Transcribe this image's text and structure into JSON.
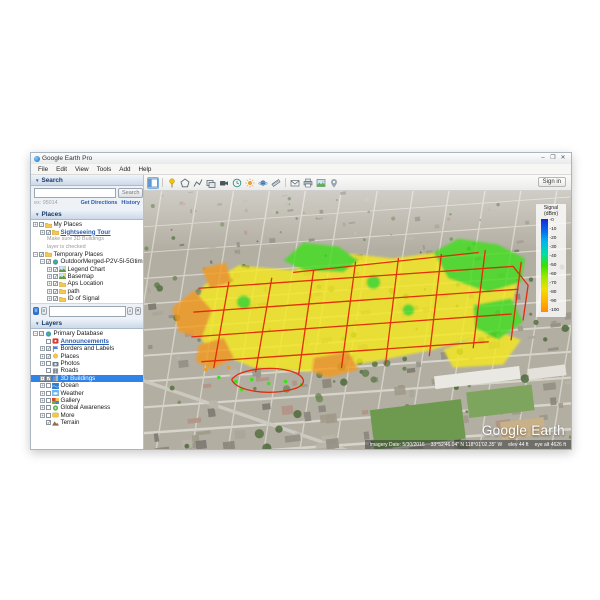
{
  "window": {
    "title": "Google Earth Pro",
    "controls": {
      "minimize": "–",
      "maximize": "❐",
      "close": "✕"
    }
  },
  "menu": {
    "items": [
      "File",
      "Edit",
      "View",
      "Tools",
      "Add",
      "Help"
    ]
  },
  "toolbar": {
    "signin_label": "Sign in",
    "icons": [
      "sidebar-toggle",
      "sep",
      "add-placemark",
      "add-polygon",
      "add-path",
      "add-image-overlay",
      "record-tour",
      "historical-imagery",
      "sunlight",
      "planets",
      "ruler",
      "sep",
      "email",
      "print",
      "save-image",
      "view-in-maps"
    ]
  },
  "search_panel": {
    "title": "Search",
    "button_label": "Search",
    "input_value": "",
    "hint": "ex: 95014",
    "links": [
      "Get Directions",
      "History"
    ]
  },
  "places_panel": {
    "title": "Places",
    "items": [
      {
        "depth": 0,
        "expander": "+",
        "checkbox": "partial",
        "icon": "folder",
        "label": "My Places"
      },
      {
        "depth": 1,
        "expander": "+",
        "checkbox": "checked",
        "icon": "folder",
        "label": "Sightseeing Tour",
        "link": true
      },
      {
        "depth": 2,
        "style": "note",
        "note": "Make sure 3D Buildings"
      },
      {
        "depth": 2,
        "style": "note",
        "note": "layer is checked"
      },
      {
        "depth": 0,
        "expander": "-",
        "checkbox": "checked",
        "icon": "folder",
        "label": "Temporary Places"
      },
      {
        "depth": 1,
        "expander": "-",
        "checkbox": "checked",
        "icon": "globe",
        "label": "OutdoorMerged-P2V-5l-5Gtime"
      },
      {
        "depth": 2,
        "expander": "+",
        "checkbox": "checked",
        "icon": "image",
        "label": "Legend Chart"
      },
      {
        "depth": 2,
        "expander": "+",
        "checkbox": "checked",
        "icon": "image",
        "label": "Basemap"
      },
      {
        "depth": 2,
        "expander": "+",
        "checkbox": "checked",
        "icon": "folder",
        "label": "Aps Location"
      },
      {
        "depth": 2,
        "expander": "+",
        "checkbox": "checked",
        "icon": "folder",
        "label": "path"
      },
      {
        "depth": 2,
        "expander": "+",
        "checkbox": "checked",
        "icon": "folder",
        "label": "ID of Signal"
      }
    ]
  },
  "layers_panel": {
    "title": "Layers",
    "items": [
      {
        "depth": 0,
        "expander": "-",
        "checkbox": "partial",
        "icon": "globe",
        "label": "Primary Database"
      },
      {
        "depth": 1,
        "checkbox": "unchecked",
        "icon": "announce",
        "label": "Announcements",
        "link": true
      },
      {
        "depth": 1,
        "expander": "+",
        "checkbox": "checked",
        "icon": "borders",
        "label": "Borders and Labels"
      },
      {
        "depth": 1,
        "expander": "+",
        "checkbox": "checked",
        "icon": "places",
        "label": "Places"
      },
      {
        "depth": 1,
        "expander": "+",
        "checkbox": "unchecked",
        "icon": "photos",
        "label": "Photos"
      },
      {
        "depth": 1,
        "checkbox": "unchecked",
        "icon": "roads",
        "label": "Roads"
      },
      {
        "depth": 1,
        "expander": "+",
        "checkbox": "checked",
        "icon": "buildings",
        "label": "3D Buildings",
        "selected": true
      },
      {
        "depth": 1,
        "expander": "+",
        "checkbox": "unchecked",
        "icon": "ocean",
        "label": "Ocean"
      },
      {
        "depth": 1,
        "expander": "+",
        "checkbox": "unchecked",
        "icon": "weather",
        "label": "Weather"
      },
      {
        "depth": 1,
        "expander": "+",
        "checkbox": "unchecked",
        "icon": "gallery",
        "label": "Gallery"
      },
      {
        "depth": 1,
        "expander": "+",
        "checkbox": "unchecked",
        "icon": "awareness",
        "label": "Global Awareness"
      },
      {
        "depth": 1,
        "expander": "+",
        "checkbox": "unchecked",
        "icon": "more",
        "label": "More"
      },
      {
        "depth": 1,
        "checkbox": "checked",
        "icon": "terrain",
        "label": "Terrain"
      }
    ]
  },
  "legend": {
    "title": "Signal",
    "subtitle": "(dBm)",
    "ticks": [
      "-0",
      "-10",
      "-20",
      "-30",
      "-40",
      "-50",
      "-60",
      "-70",
      "-80",
      "-90",
      "-100"
    ],
    "colors_top_to_bottom": [
      "#1428d0",
      "#00b4f0",
      "#38e000",
      "#f0e000",
      "#ff8c00"
    ]
  },
  "map": {
    "watermark": "Google Earth",
    "status": {
      "imagery_date": "Imagery Date: 5/30/2016",
      "coords": "33°52'46.04\" N  118°01'02.35\" W",
      "elev": "elev 44 ft",
      "eye_alt": "eye alt 4626 ft"
    },
    "overlay_colors": {
      "good": "#3fdf1f",
      "mid": "#f7ea1c",
      "low": "#f59a1a",
      "route": "#e22706"
    }
  }
}
